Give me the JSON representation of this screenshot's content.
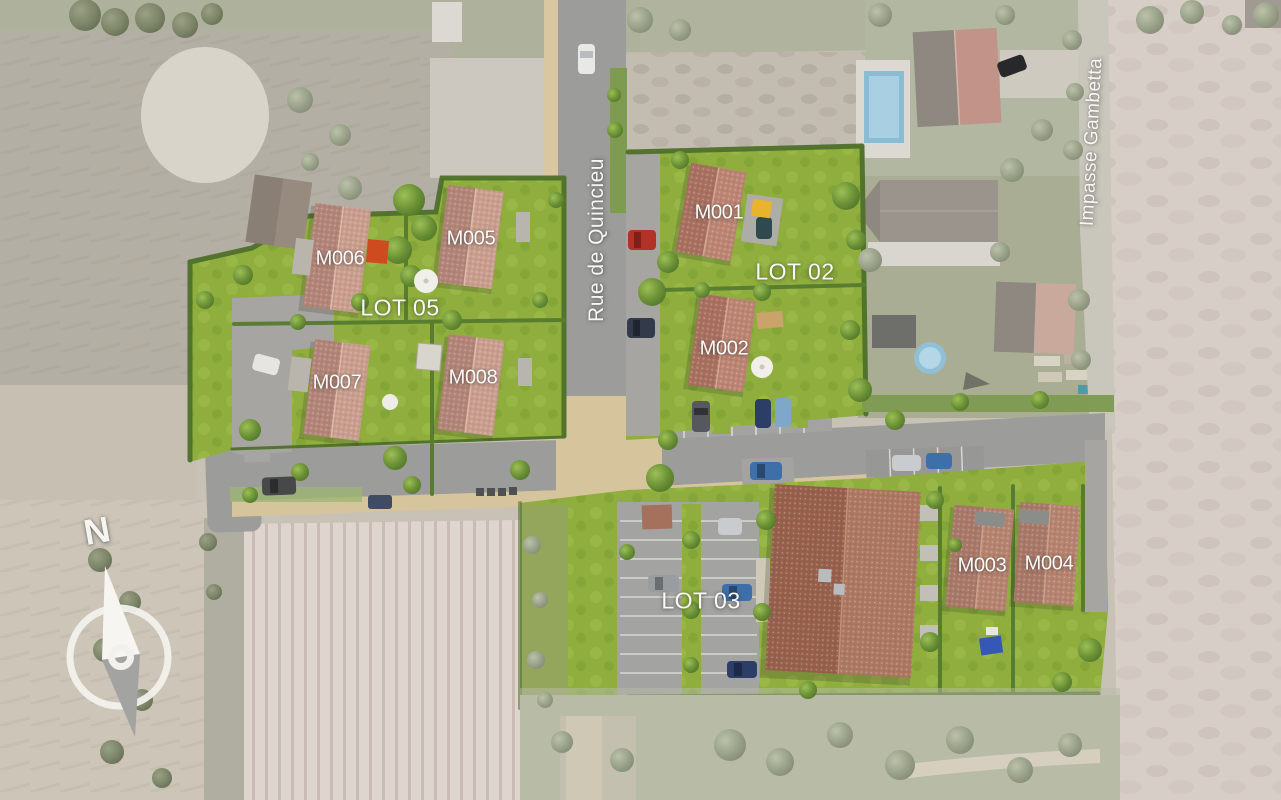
{
  "page": {
    "type": "residential-development-masterplan-aerial-view"
  },
  "compass": {
    "north": "N"
  },
  "streets": {
    "rue_de_quincieu": "Rue de Quincieu",
    "impasse_gambetta": "Impasse Gambetta"
  },
  "lots": {
    "lot02": {
      "label": "LOT 02"
    },
    "lot03": {
      "label": "LOT 03"
    },
    "lot05": {
      "label": "LOT 05"
    }
  },
  "buildings": {
    "m001": {
      "label": "M001"
    },
    "m002": {
      "label": "M002"
    },
    "m003": {
      "label": "M003"
    },
    "m004": {
      "label": "M004"
    },
    "m005": {
      "label": "M005"
    },
    "m006": {
      "label": "M006"
    },
    "m007": {
      "label": "M007"
    },
    "m008": {
      "label": "M008"
    }
  },
  "colors": {
    "lawn_green": "#8fae3e",
    "hedge_green": "#4f702b",
    "road_gray": "#9c9c9a",
    "path_beige": "#d6c49c",
    "roof_terracotta_light": "#c99e8e",
    "roof_terracotta_dark": "#a8705f",
    "washed_field_pink": "#d8cec8",
    "pool_blue": "#8fc0d6",
    "parasol_yellow": "#e9b42c",
    "parasol_red": "#cf4a1e",
    "parasol_blue": "#3558b8",
    "label_white": "#ffffff"
  }
}
